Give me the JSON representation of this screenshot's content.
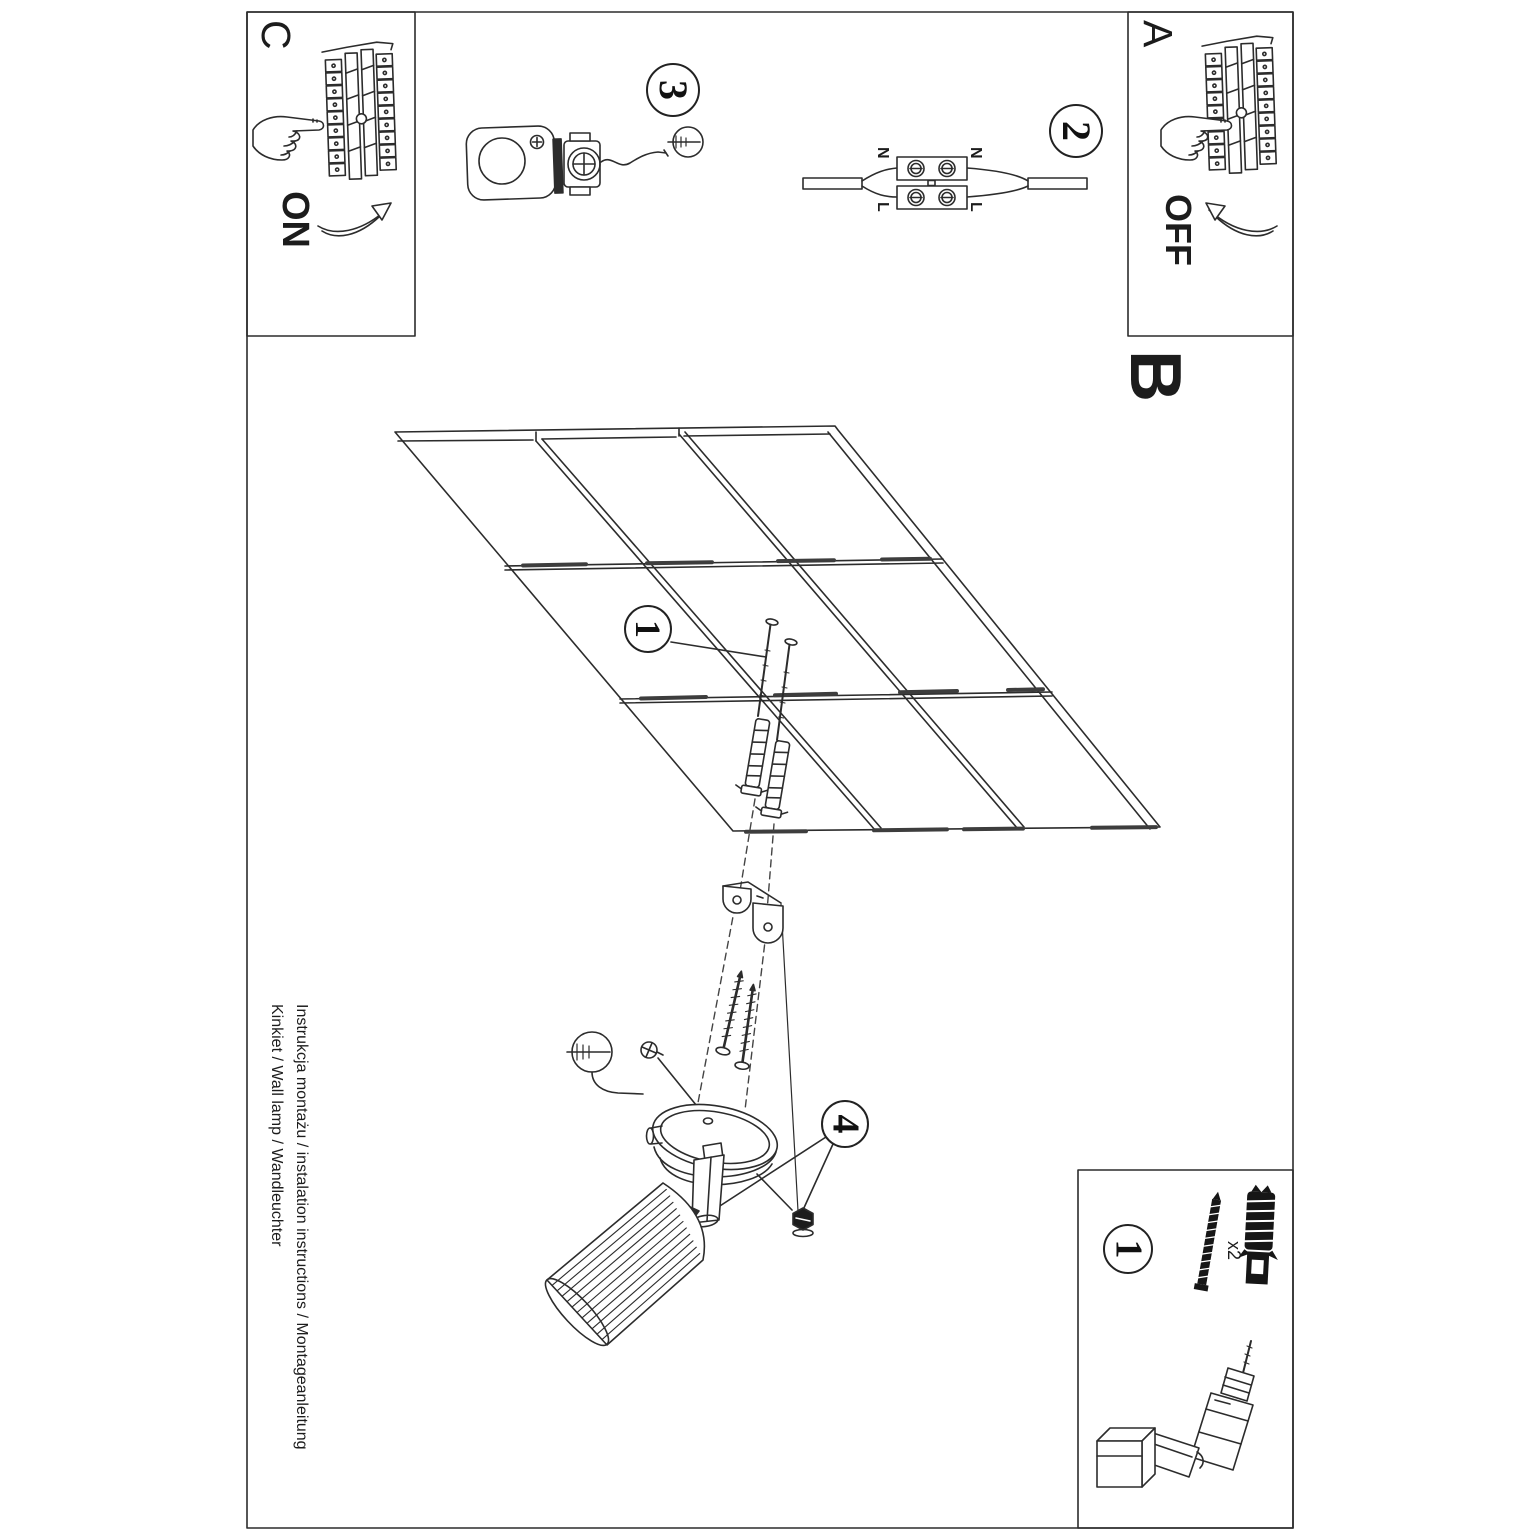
{
  "sheet": {
    "sections": {
      "a_label": "A",
      "b_label": "B",
      "c_label": "C"
    },
    "power": {
      "on_label": "ON",
      "off_label": "OFF"
    },
    "wiring_labels": {
      "neutral": "N",
      "live": "L"
    },
    "step_badges": {
      "step1": "1",
      "step2": "2",
      "step3": "3",
      "step4": "4",
      "parts_step": "1"
    },
    "parts": {
      "screw_qty": "x2"
    },
    "footer": {
      "line1": "Instrukcja montażu / instalation instructions / Montageanleitung",
      "line2": "Kinkiet / Wall lamp / Wandleuchter"
    },
    "icons": {
      "flat_screwdriver": "circle-with-slot-and-blade",
      "pressing_hand": "hand-outline",
      "power_drill": "drill-outline",
      "curved_arrow": "swoosh-arrow"
    },
    "colors": {
      "ink": "#2c2c2c",
      "border": "#4a4a4a"
    }
  }
}
